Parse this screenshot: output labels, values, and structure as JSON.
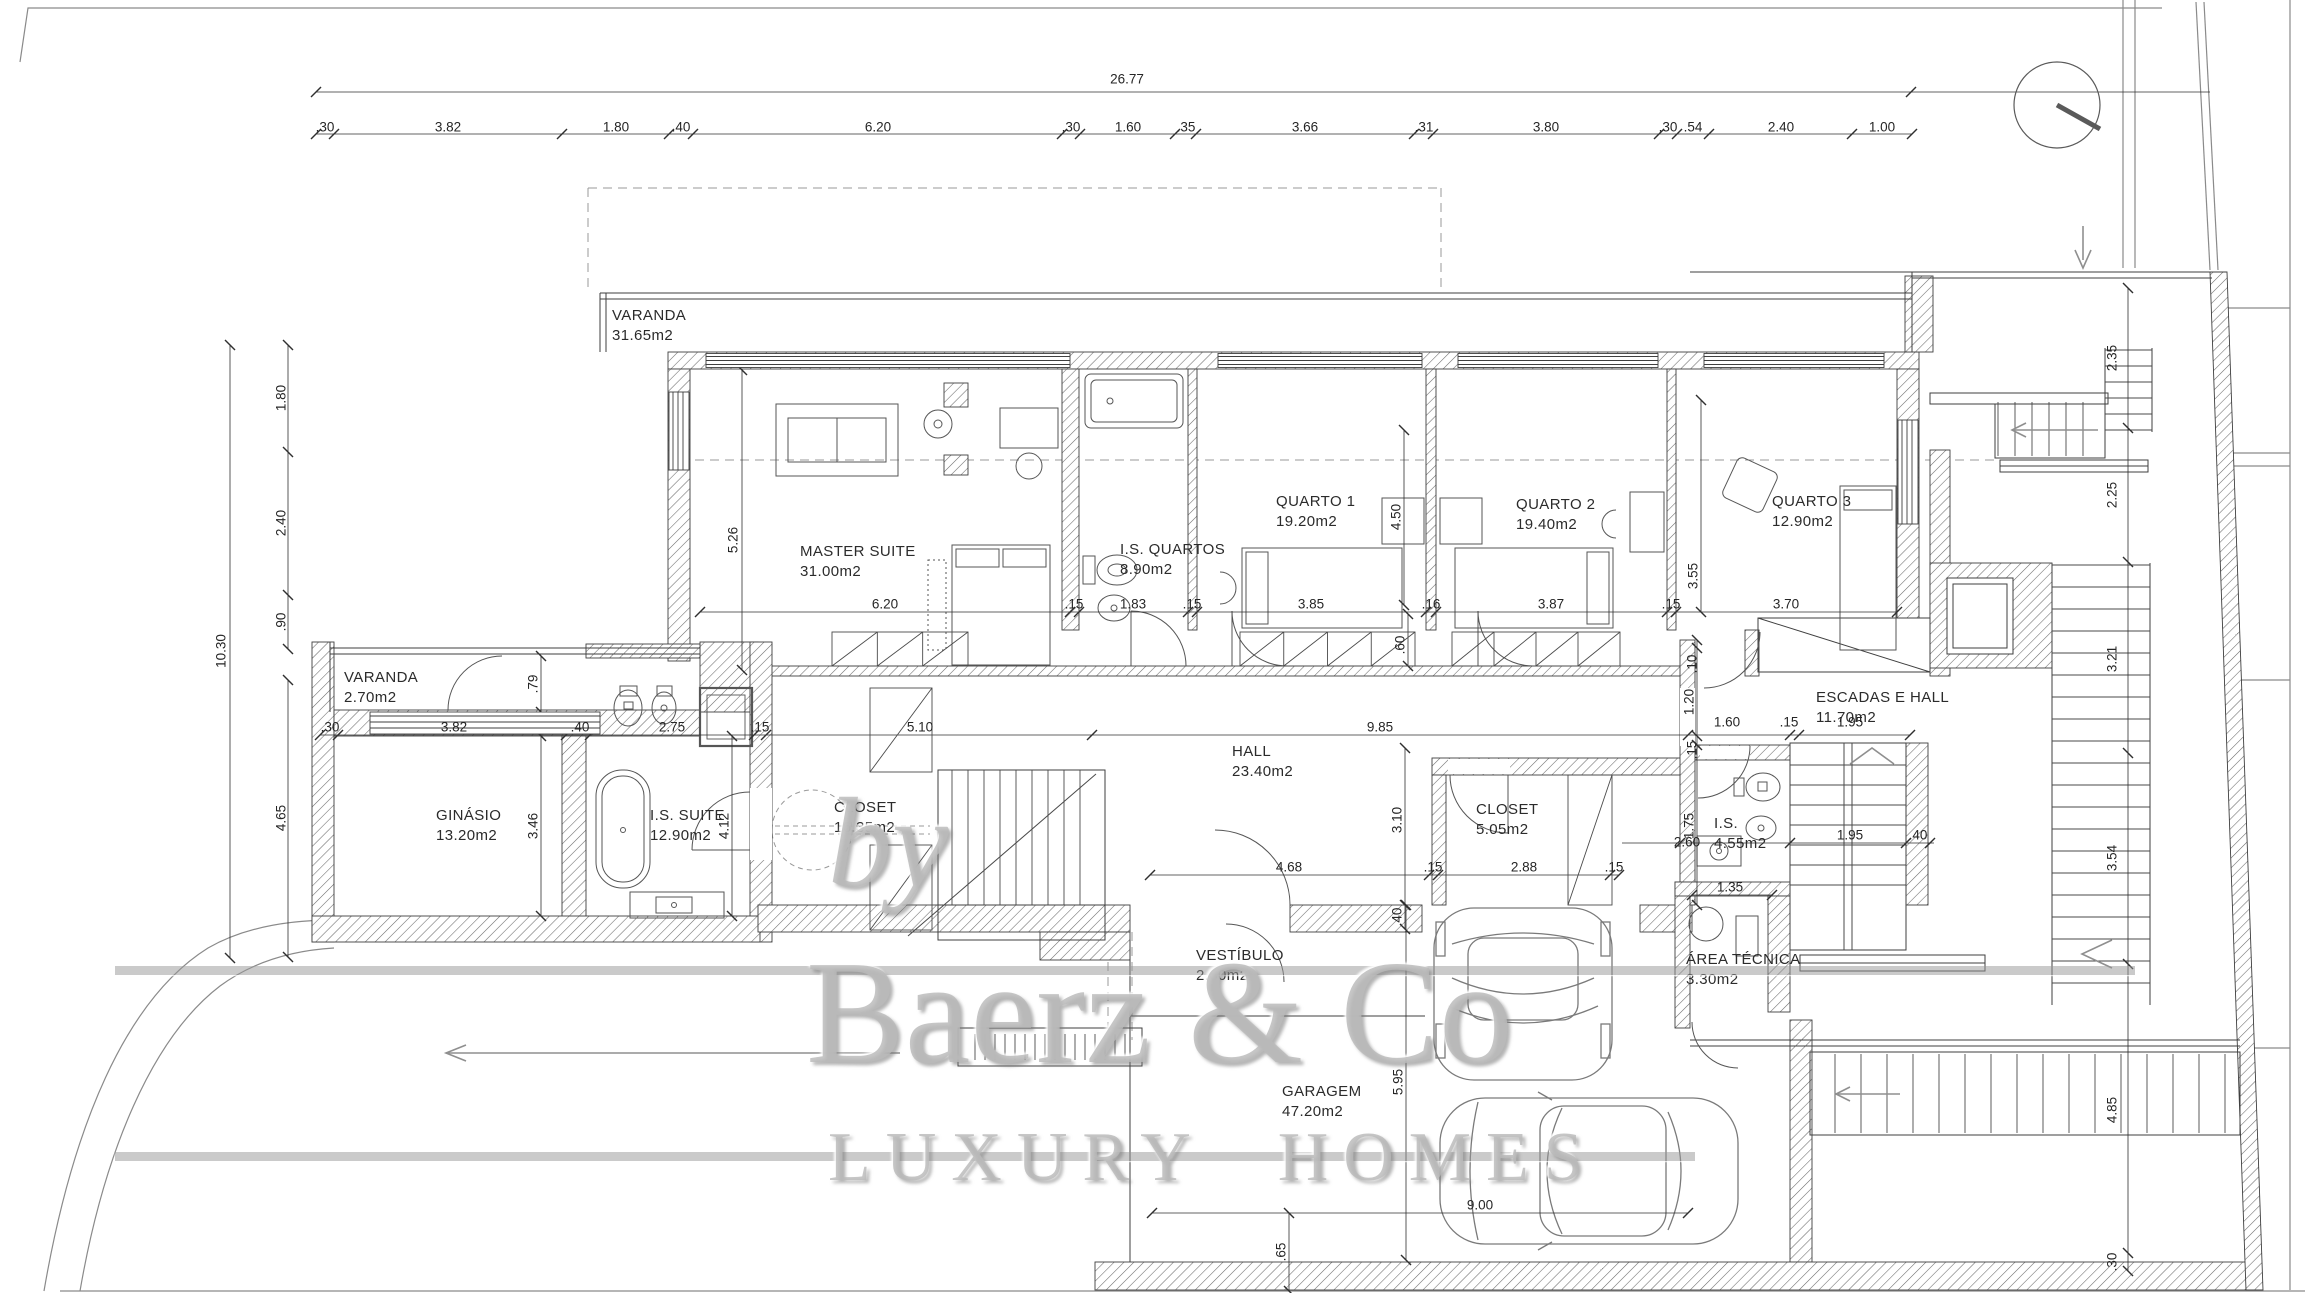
{
  "watermark": {
    "by": "by",
    "brand": "Baerz & Co",
    "tagline": "LUXURY HOMES"
  },
  "plan": {
    "rooms": [
      {
        "name": "VARANDA",
        "area": "31.65m2",
        "x": 612,
        "y": 306
      },
      {
        "name": "MASTER SUITE",
        "area": "31.00m2",
        "x": 800,
        "y": 542
      },
      {
        "name": "I.S. QUARTOS",
        "area": "8.90m2",
        "x": 1120,
        "y": 540
      },
      {
        "name": "QUARTO 1",
        "area": "19.20m2",
        "x": 1276,
        "y": 492
      },
      {
        "name": "QUARTO 2",
        "area": "19.40m2",
        "x": 1516,
        "y": 495
      },
      {
        "name": "QUARTO 3",
        "area": "12.90m2",
        "x": 1772,
        "y": 492
      },
      {
        "name": "VARANDA",
        "area": "2.70m2",
        "x": 344,
        "y": 668
      },
      {
        "name": "GINÁSIO",
        "area": "13.20m2",
        "x": 436,
        "y": 806
      },
      {
        "name": "I.S. SUITE",
        "area": "12.90m2",
        "x": 650,
        "y": 806
      },
      {
        "name": "CLOSET",
        "area": "16.35m2",
        "x": 834,
        "y": 798
      },
      {
        "name": "HALL",
        "area": "23.40m2",
        "x": 1232,
        "y": 742
      },
      {
        "name": "CLOSET",
        "area": "5.05m2",
        "x": 1476,
        "y": 800
      },
      {
        "name": "I.S.",
        "area": "4.55m2",
        "x": 1714,
        "y": 814
      },
      {
        "name": "ESCADAS E HALL",
        "area": "11.70m2",
        "x": 1816,
        "y": 688
      },
      {
        "name": "ÁREA TÉCNICA",
        "area": "3.30m2",
        "x": 1686,
        "y": 950
      },
      {
        "name": "VESTÍBULO",
        "area": "2.60m2",
        "x": 1196,
        "y": 946
      },
      {
        "name": "GARAGEM",
        "area": "47.20m2",
        "x": 1282,
        "y": 1082
      }
    ],
    "dims": [
      {
        "v": "26.77",
        "x": 1127,
        "y": 79
      },
      {
        "v": ".30",
        "x": 325,
        "y": 127
      },
      {
        "v": "3.82",
        "x": 448,
        "y": 127
      },
      {
        "v": "1.80",
        "x": 616,
        "y": 127
      },
      {
        "v": ".40",
        "x": 681,
        "y": 127
      },
      {
        "v": "6.20",
        "x": 878,
        "y": 127
      },
      {
        "v": ".30",
        "x": 1071,
        "y": 127
      },
      {
        "v": "1.60",
        "x": 1128,
        "y": 127
      },
      {
        "v": ".35",
        "x": 1186,
        "y": 127
      },
      {
        "v": "3.66",
        "x": 1305,
        "y": 127
      },
      {
        "v": ".31",
        "x": 1424,
        "y": 127
      },
      {
        "v": "3.80",
        "x": 1546,
        "y": 127
      },
      {
        "v": ".30",
        "x": 1668,
        "y": 127
      },
      {
        "v": ".54",
        "x": 1693,
        "y": 127
      },
      {
        "v": "2.40",
        "x": 1781,
        "y": 127
      },
      {
        "v": "1.00",
        "x": 1882,
        "y": 127
      },
      {
        "v": "10.30",
        "x": 221,
        "y": 651,
        "r": -90
      },
      {
        "v": "1.80",
        "x": 281,
        "y": 398,
        "r": -90
      },
      {
        "v": "2.40",
        "x": 281,
        "y": 523,
        "r": -90
      },
      {
        "v": ".90",
        "x": 281,
        "y": 622,
        "r": -90
      },
      {
        "v": "4.65",
        "x": 281,
        "y": 818,
        "r": -90
      },
      {
        "v": "2.35",
        "x": 2112,
        "y": 358,
        "r": -90
      },
      {
        "v": "2.25",
        "x": 2112,
        "y": 495,
        "r": -90
      },
      {
        "v": "3.21",
        "x": 2112,
        "y": 659,
        "r": -90
      },
      {
        "v": "3.54",
        "x": 2112,
        "y": 858,
        "r": -90
      },
      {
        "v": "4.85",
        "x": 2112,
        "y": 1110,
        "r": -90
      },
      {
        "v": ".30",
        "x": 2112,
        "y": 1262,
        "r": -90
      },
      {
        "v": "6.20",
        "x": 885,
        "y": 604
      },
      {
        "v": ".15",
        "x": 1074,
        "y": 604
      },
      {
        "v": "1.83",
        "x": 1133,
        "y": 604
      },
      {
        "v": ".15",
        "x": 1192,
        "y": 604
      },
      {
        "v": "3.85",
        "x": 1311,
        "y": 604
      },
      {
        "v": ".16",
        "x": 1431,
        "y": 604
      },
      {
        "v": "3.87",
        "x": 1551,
        "y": 604
      },
      {
        "v": ".15",
        "x": 1671,
        "y": 604
      },
      {
        "v": "3.70",
        "x": 1786,
        "y": 604
      },
      {
        "v": "5.26",
        "x": 733,
        "y": 540,
        "r": -90
      },
      {
        "v": "4.50",
        "x": 1396,
        "y": 517,
        "r": -90
      },
      {
        "v": "3.55",
        "x": 1693,
        "y": 576,
        "r": -90
      },
      {
        "v": ".60",
        "x": 1400,
        "y": 645,
        "r": -90
      },
      {
        "v": ".30",
        "x": 330,
        "y": 727
      },
      {
        "v": "3.82",
        "x": 454,
        "y": 727
      },
      {
        "v": ".40",
        "x": 580,
        "y": 727
      },
      {
        "v": "2.75",
        "x": 672,
        "y": 727
      },
      {
        "v": ".15",
        "x": 760,
        "y": 727
      },
      {
        "v": "5.10",
        "x": 920,
        "y": 727
      },
      {
        "v": "9.85",
        "x": 1380,
        "y": 727
      },
      {
        "v": "1.60",
        "x": 1727,
        "y": 722
      },
      {
        "v": ".15",
        "x": 1789,
        "y": 722
      },
      {
        "v": "1.95",
        "x": 1850,
        "y": 722
      },
      {
        "v": ".79",
        "x": 533,
        "y": 684,
        "r": -90
      },
      {
        "v": "3.46",
        "x": 533,
        "y": 826,
        "r": -90
      },
      {
        "v": "4.12",
        "x": 724,
        "y": 826,
        "r": -90
      },
      {
        "v": "3.10",
        "x": 1397,
        "y": 820,
        "r": -90
      },
      {
        "v": ".40",
        "x": 1397,
        "y": 917,
        "r": -90
      },
      {
        "v": ".10",
        "x": 1692,
        "y": 664,
        "r": -90
      },
      {
        "v": "1.20",
        "x": 1689,
        "y": 702,
        "r": -90
      },
      {
        "v": ".15",
        "x": 1692,
        "y": 750,
        "r": -90
      },
      {
        "v": "1.75",
        "x": 1689,
        "y": 826,
        "r": -90
      },
      {
        "v": "4.68",
        "x": 1289,
        "y": 867
      },
      {
        "v": ".15",
        "x": 1433,
        "y": 867
      },
      {
        "v": "2.88",
        "x": 1524,
        "y": 867
      },
      {
        "v": ".15",
        "x": 1614,
        "y": 867
      },
      {
        "v": "2.60",
        "x": 1687,
        "y": 842
      },
      {
        "v": "1.95",
        "x": 1850,
        "y": 835
      },
      {
        "v": ".40",
        "x": 1918,
        "y": 835
      },
      {
        "v": "1.35",
        "x": 1730,
        "y": 887
      },
      {
        "v": "5.95",
        "x": 1398,
        "y": 1082,
        "r": -90
      },
      {
        "v": "9.00",
        "x": 1480,
        "y": 1205
      },
      {
        "v": ".65",
        "x": 1281,
        "y": 1252,
        "r": -90
      }
    ]
  }
}
